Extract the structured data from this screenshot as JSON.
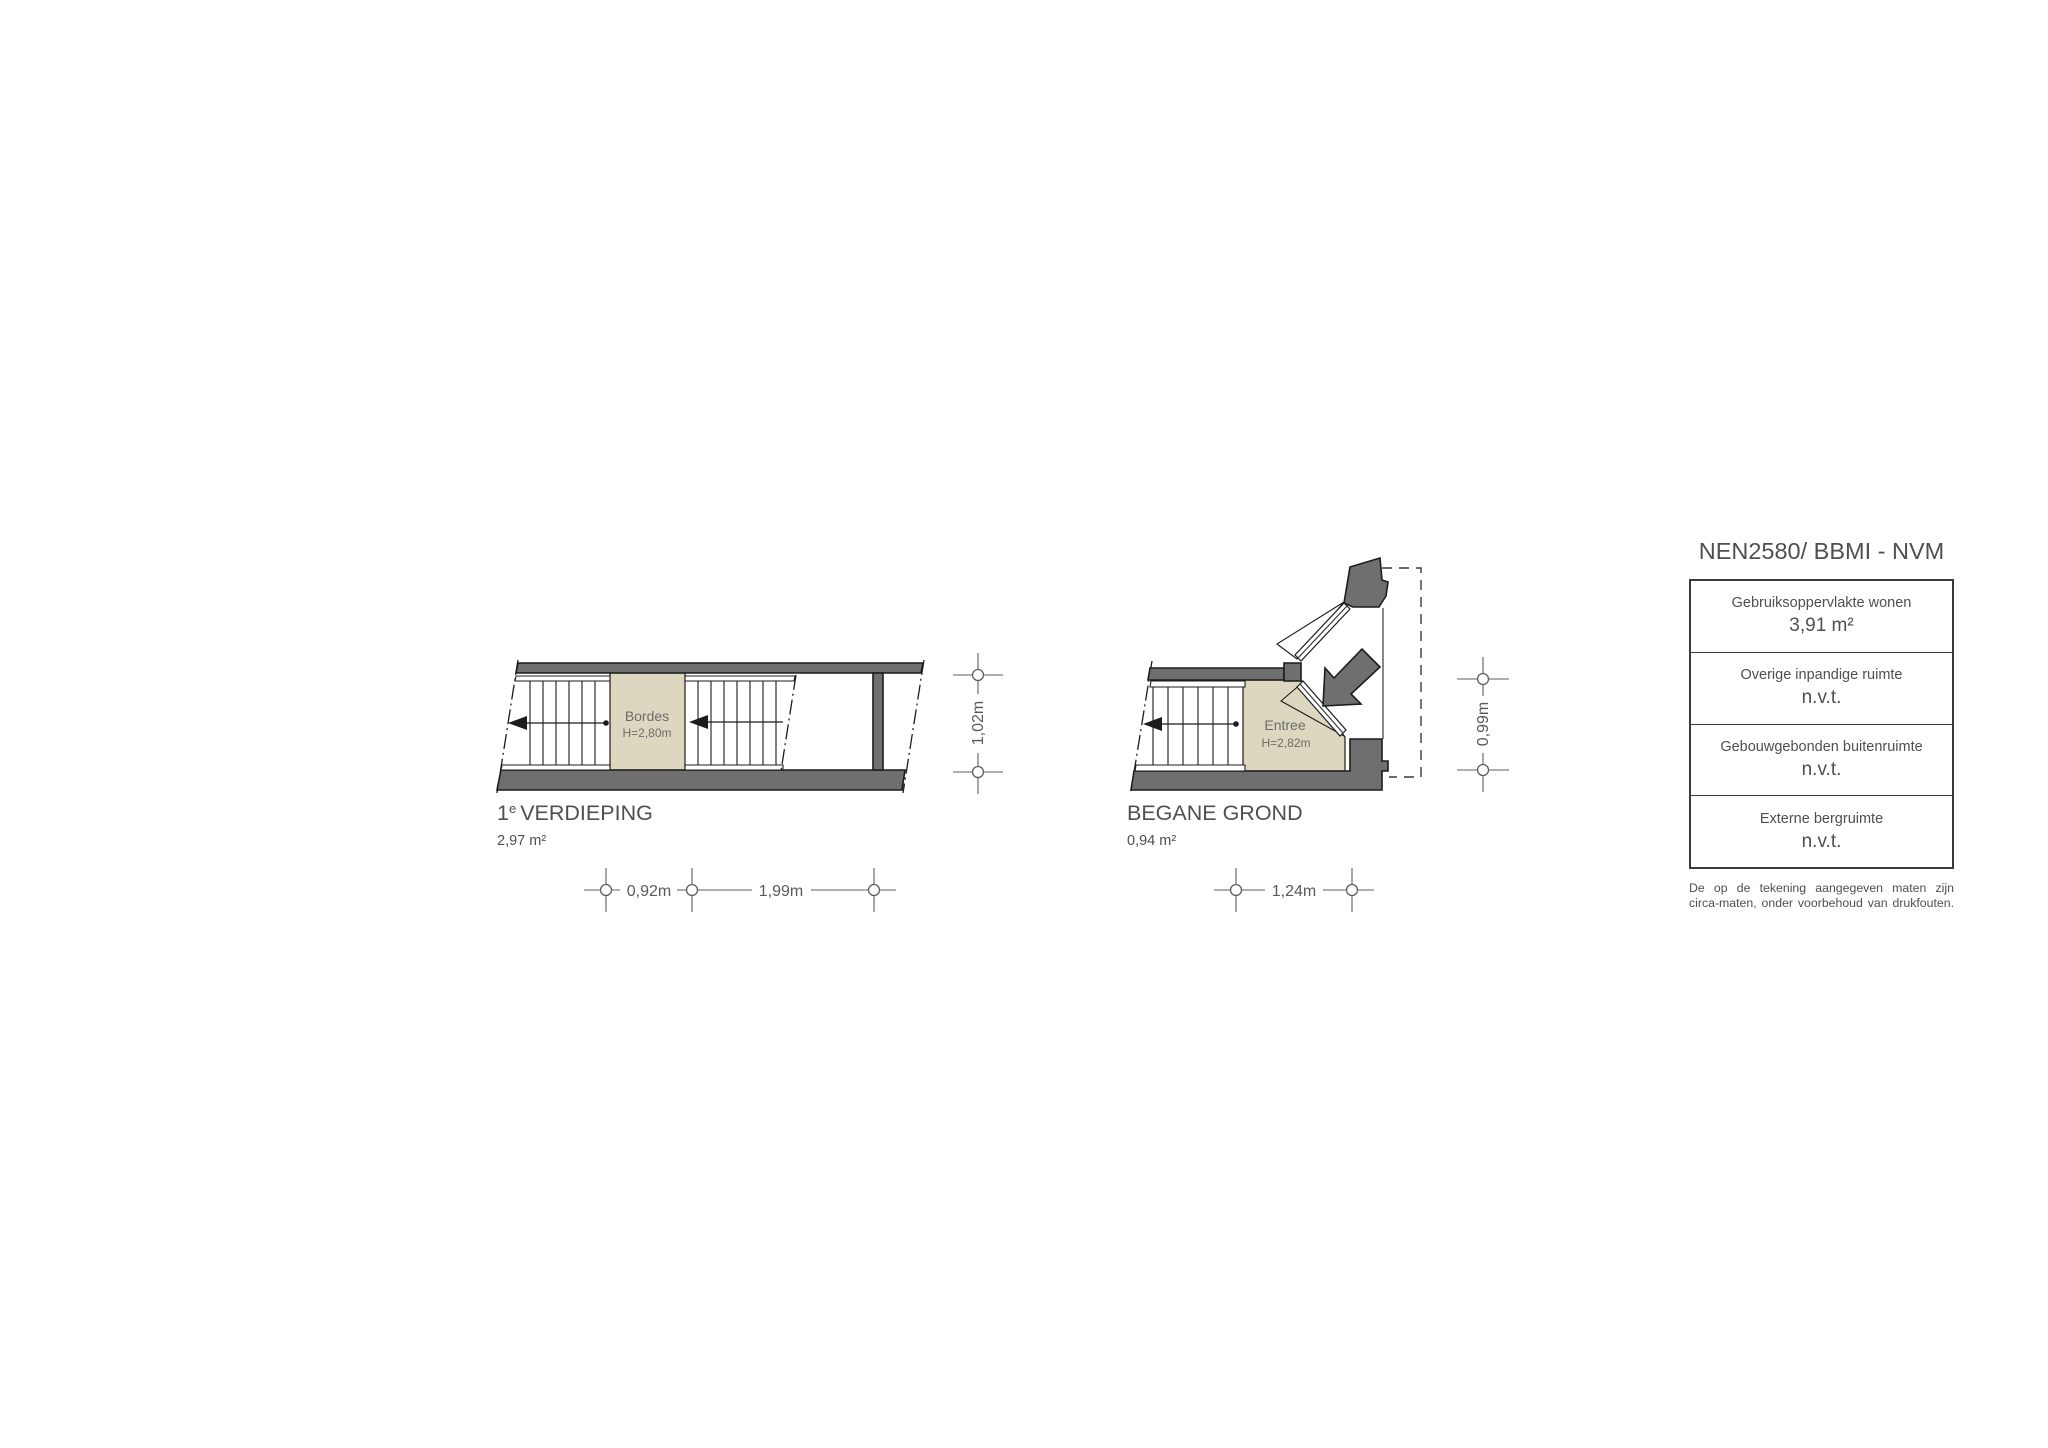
{
  "plans": [
    {
      "name": "1e verdieping",
      "title_num": "1",
      "title_sup": "e",
      "title_rest": "VERDIEPING",
      "area": "2,97 m²",
      "room": {
        "name": "Bordes",
        "height": "H=2,80m"
      },
      "dims": {
        "w1": "0,92m",
        "w2": "1,99m",
        "h": "1,02m"
      }
    },
    {
      "name": "begane grond",
      "title": "BEGANE GROND",
      "area": "0,94 m²",
      "room": {
        "name": "Entree",
        "height": "H=2,82m"
      },
      "dims": {
        "w1": "1,24m",
        "h": "0,99m"
      }
    }
  ],
  "legend": {
    "title": "NEN2580/ BBMI - NVM",
    "rows": [
      {
        "label": "Gebruiksoppervlakte wonen",
        "value": "3,91 m²"
      },
      {
        "label": "Overige inpandige ruimte",
        "value": "n.v.t."
      },
      {
        "label": "Gebouwgebonden buitenruimte",
        "value": "n.v.t."
      },
      {
        "label": "Externe bergruimte",
        "value": "n.v.t."
      }
    ],
    "disclaimer": [
      "De op de tekening aangegeven maten zijn",
      "circa-maten, onder voorbehoud van drukfouten."
    ]
  },
  "colors": {
    "wall": "#6f6f6f",
    "floor_fill": "#ded7bf",
    "outline": "#1c1c1c",
    "dimension": "#5f5f5f",
    "text": "#4f4f4f"
  }
}
